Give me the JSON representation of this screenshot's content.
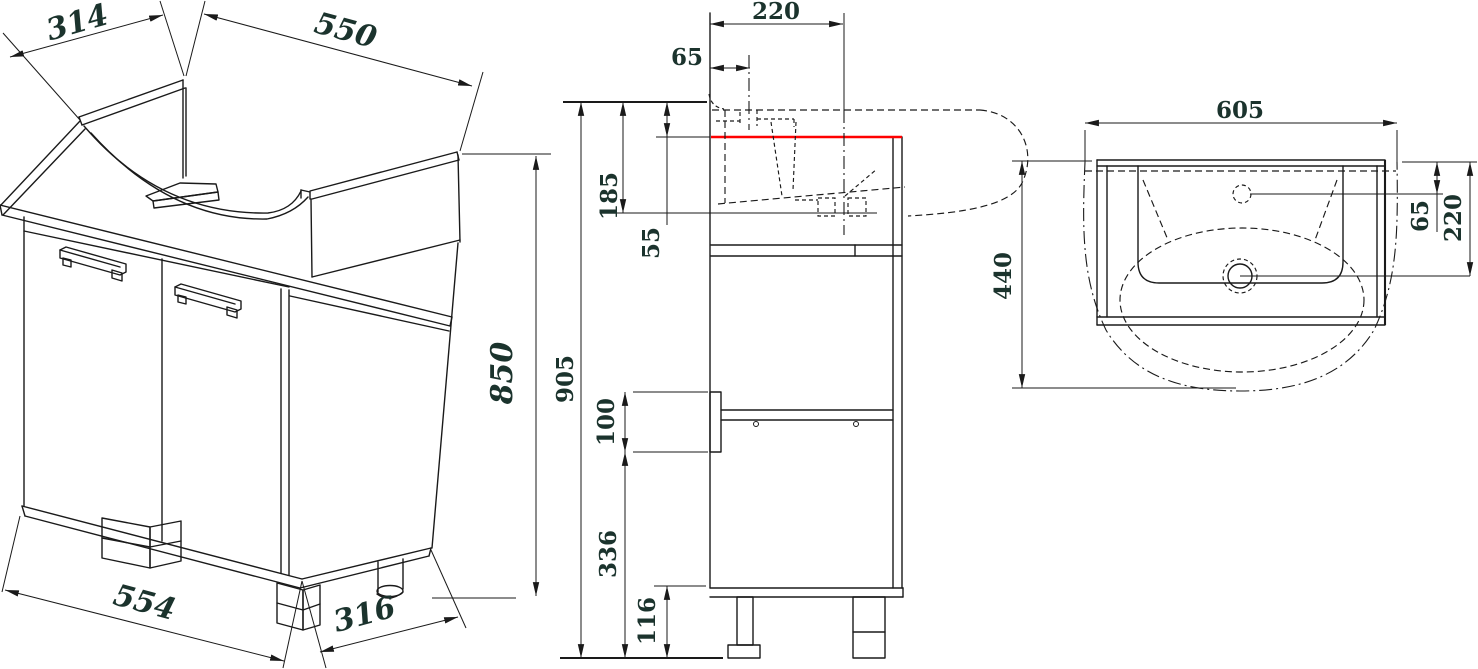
{
  "drawing": {
    "kind": "technical dimension drawing",
    "subject": "bathroom vanity cabinet with semi-recessed washbasin, three views",
    "colors": {
      "line": "#1a1a1a",
      "highlight_line": "#ff0000",
      "dimension_text": "#1b332d",
      "background": "#ffffff"
    }
  },
  "isometric": {
    "top_depth": "314",
    "top_width": "550",
    "cabinet_height": "850",
    "bottom_width": "554",
    "bottom_depth": "316"
  },
  "side": {
    "drain_axis_offset": "220",
    "faucet_axis_offset": "65",
    "basin_zone_height": "185",
    "basin_above_cabinet": "55",
    "overall_height": "905",
    "shelf_clearance": "100",
    "shelf_to_floor": "336",
    "plinth_height": "116"
  },
  "top": {
    "basin_width": "605",
    "basin_depth": "440",
    "faucet_from_back_edge": "65",
    "drain_from_back_edge": "220"
  }
}
